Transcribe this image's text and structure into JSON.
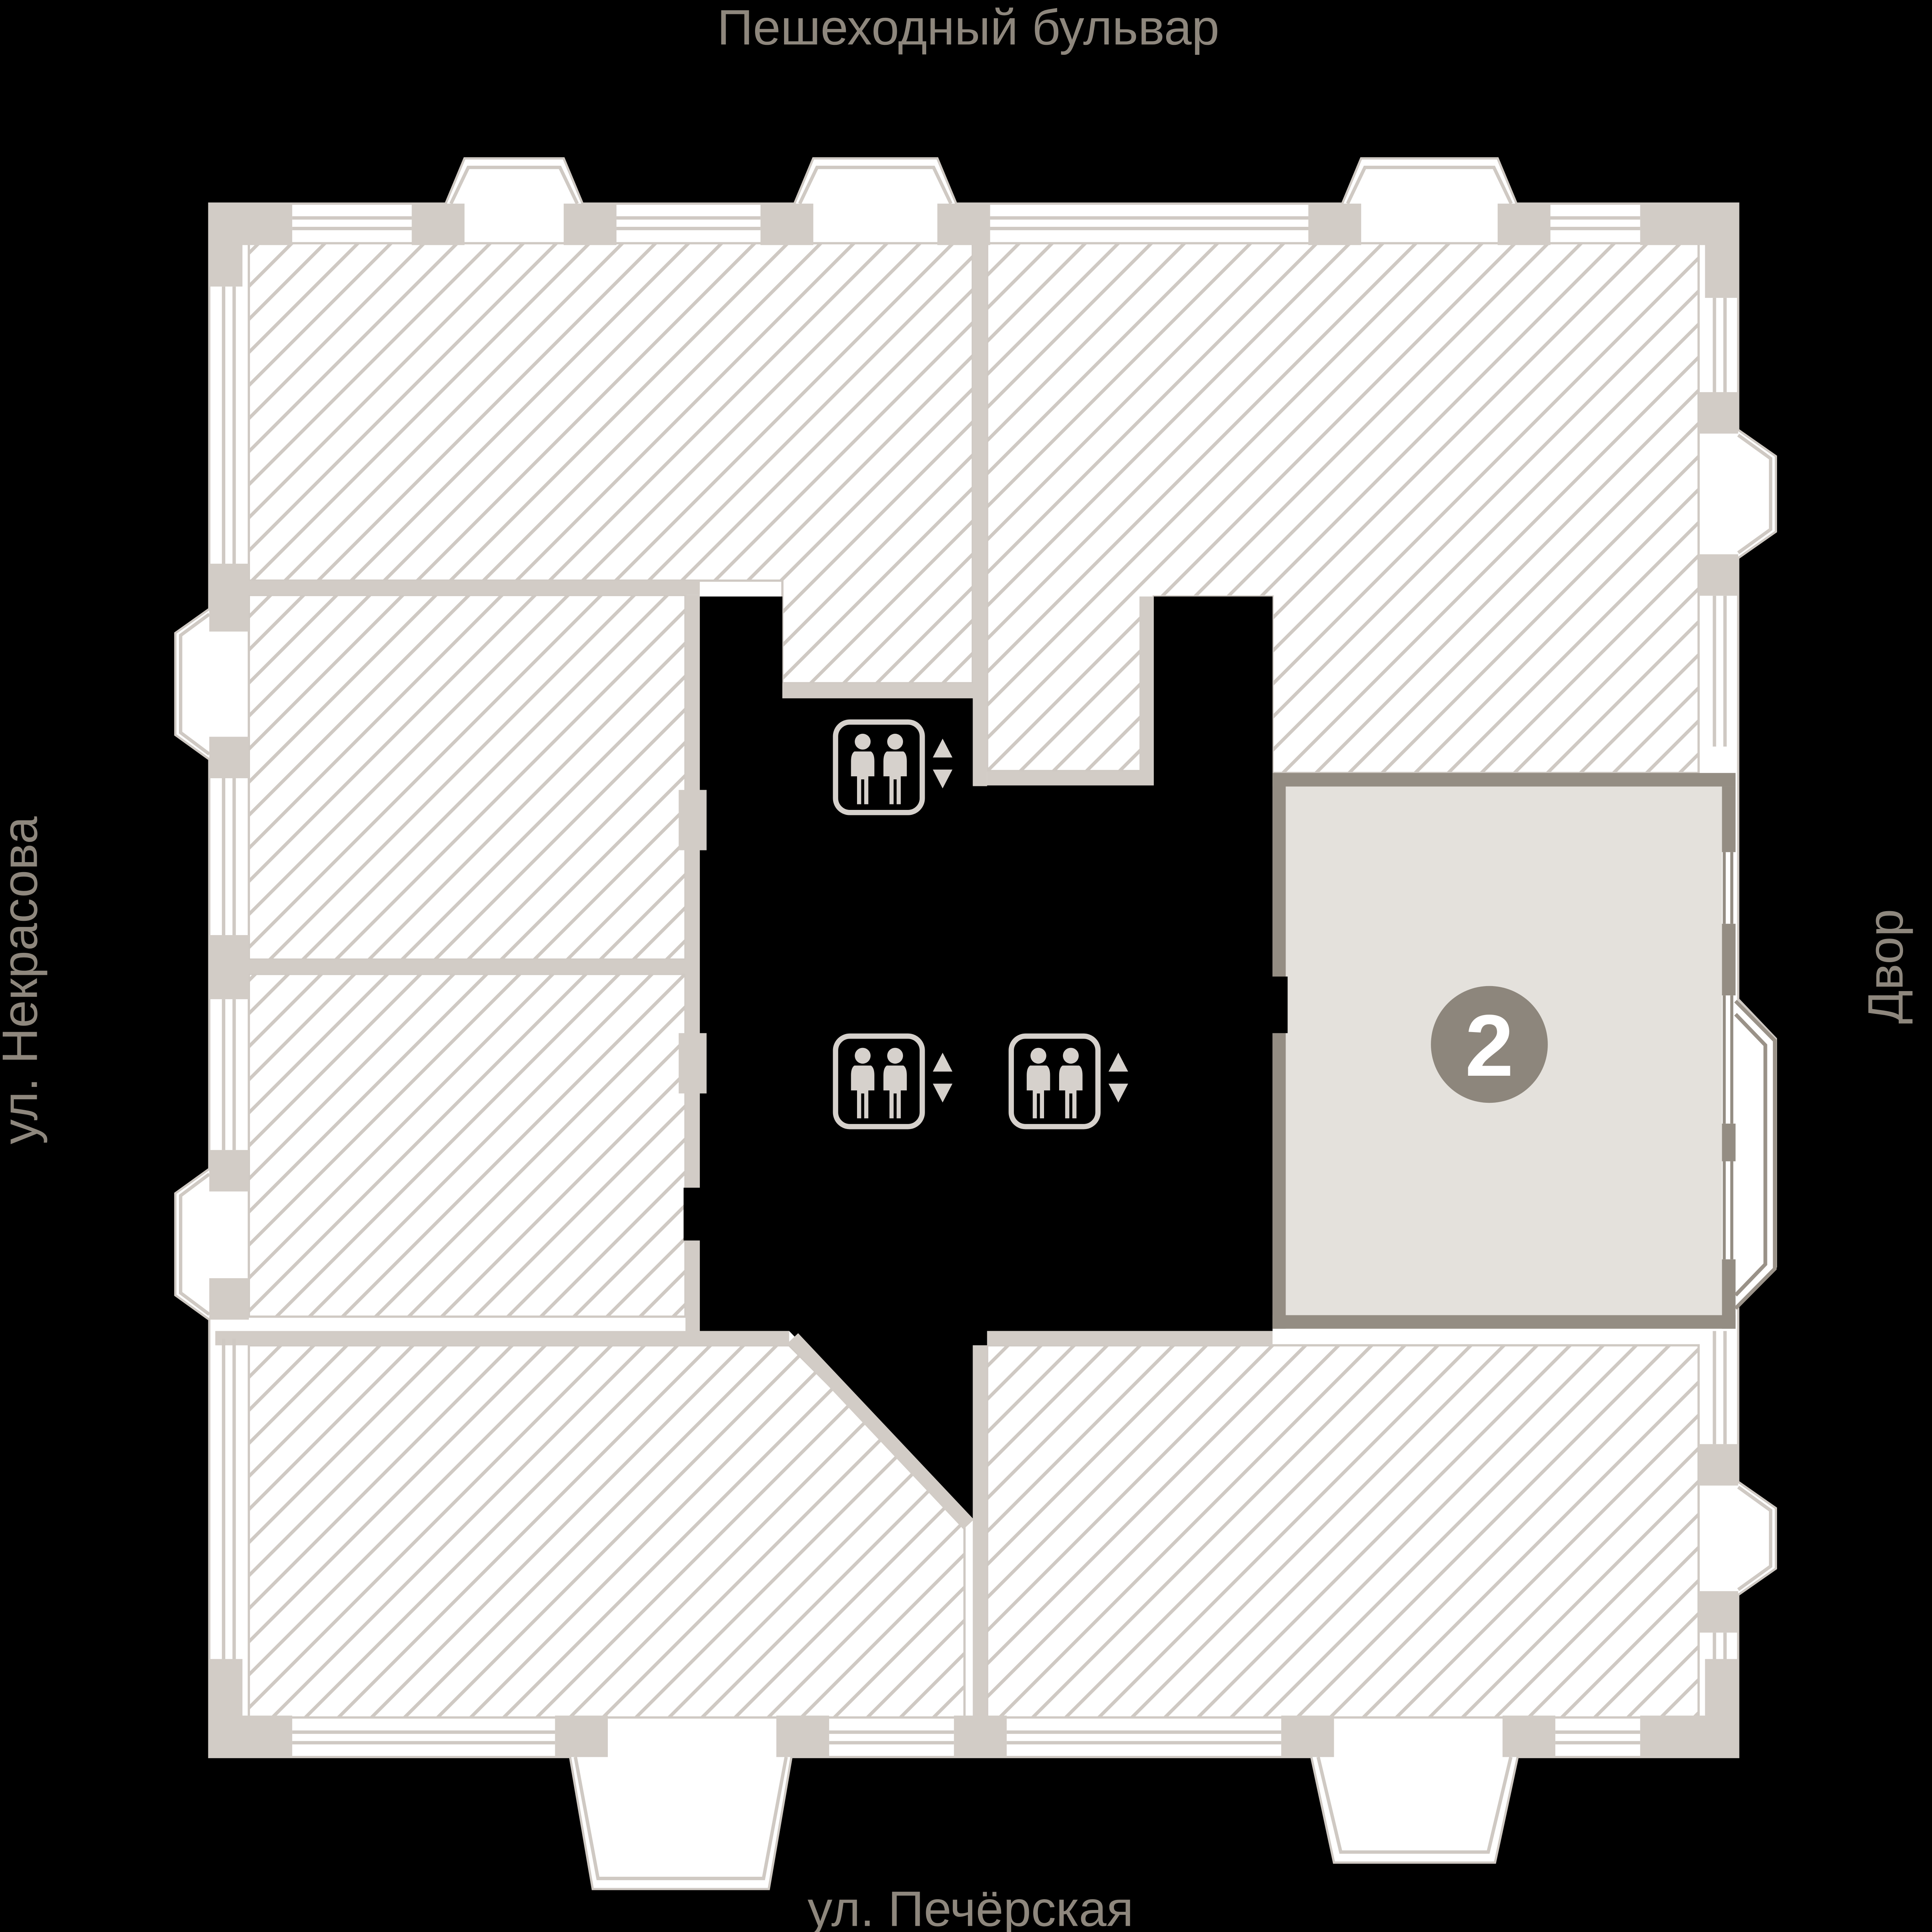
{
  "streets": {
    "top": "Пешеходный бульвар",
    "left": "ул. Некрасова",
    "right": "Двор",
    "bottom": "ул. Печёрская"
  },
  "unit": {
    "number": "2"
  },
  "icons": {
    "elevator": "elevator-people-icon",
    "arrow_up": "arrow-up-icon",
    "arrow_down": "arrow-down-icon"
  },
  "colors": {
    "background": "#000000",
    "room_fill": "#ffffff",
    "hatch_line": "#cfc9c3",
    "wall_light": "#d2ccc6",
    "wall_dark": "#948d83",
    "unit_fill": "#e4e1dc",
    "badge": "#8d867c",
    "label_text": "#8e877d",
    "icon": "#d6d1cc"
  }
}
